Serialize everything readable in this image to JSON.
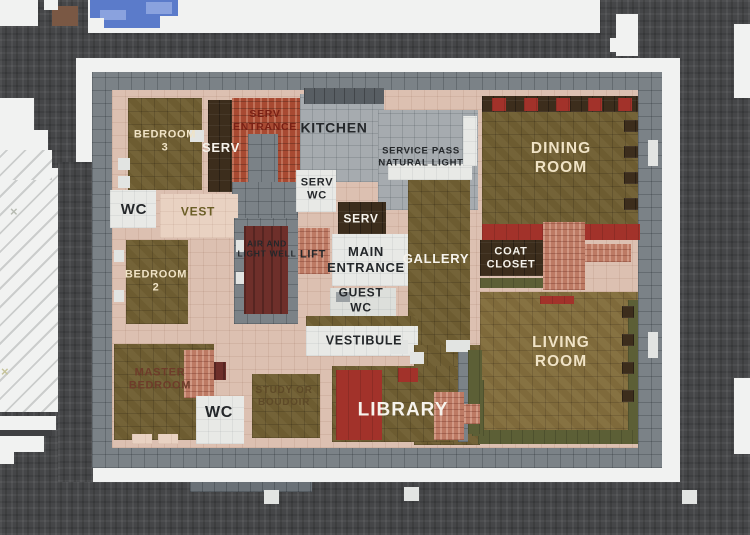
{
  "rooms": [
    {
      "id": "bedroom-3",
      "label": "BEDROOM\n3"
    },
    {
      "id": "serv-west",
      "label": "SERV"
    },
    {
      "id": "serv-entrance",
      "label": "SERV\nENTRANCE"
    },
    {
      "id": "kitchen",
      "label": "KITCHEN"
    },
    {
      "id": "service-pass",
      "label": "SERVICE PASS\nNATURAL LIGHT"
    },
    {
      "id": "dining-room",
      "label": "DINING\nROOM"
    },
    {
      "id": "wc-north",
      "label": "WC"
    },
    {
      "id": "vest",
      "label": "VEST"
    },
    {
      "id": "serv-wc",
      "label": "SERV\nWC"
    },
    {
      "id": "serv-center",
      "label": "SERV"
    },
    {
      "id": "air-light-well",
      "label": "AIR AND\nLIGHT WELL"
    },
    {
      "id": "lift",
      "label": "LIFT"
    },
    {
      "id": "main-entrance",
      "label": "MAIN\nENTRANCE"
    },
    {
      "id": "gallery",
      "label": "GALLERY"
    },
    {
      "id": "coat-closet",
      "label": "COAT\nCLOSET"
    },
    {
      "id": "bedroom-2",
      "label": "BEDROOM\n2"
    },
    {
      "id": "guest-wc",
      "label": "GUEST\nWC"
    },
    {
      "id": "vestibule",
      "label": "VESTIBULE"
    },
    {
      "id": "living-room",
      "label": "LIVING\nROOM"
    },
    {
      "id": "master-bedroom",
      "label": "MASTER\nBEDROOM"
    },
    {
      "id": "wc-south",
      "label": "WC"
    },
    {
      "id": "study",
      "label": "STUDY OR\nBOUDOIR"
    },
    {
      "id": "library",
      "label": "LIBRARY"
    }
  ],
  "marks": {
    "cross_upper": "×",
    "cross_lower": "×"
  },
  "colors": {
    "street": "#454648",
    "sidewalk": "#f1f2f1",
    "stone_wall": "#7b8287",
    "interior_wall_pink": "#dcc0b1",
    "wood_floor": "#6d5c31",
    "wood_floor_light": "#7f6a3b",
    "dark_brown_floor": "#3c2d1c",
    "red_brick": "#a84a32",
    "fireplace_brick": "#bd7a64",
    "red_carpet": "#a2322a",
    "air_well_maroon": "#6e2f2a",
    "gray_tile": "#a6abaf",
    "white_floor": "#e8e9e6",
    "plant_olive": "#5c5f36",
    "pool_blue": "#5b7bca",
    "label_cream": "#f0e3c6",
    "label_dark": "#24272a",
    "label_dark_red": "#7a2014"
  }
}
